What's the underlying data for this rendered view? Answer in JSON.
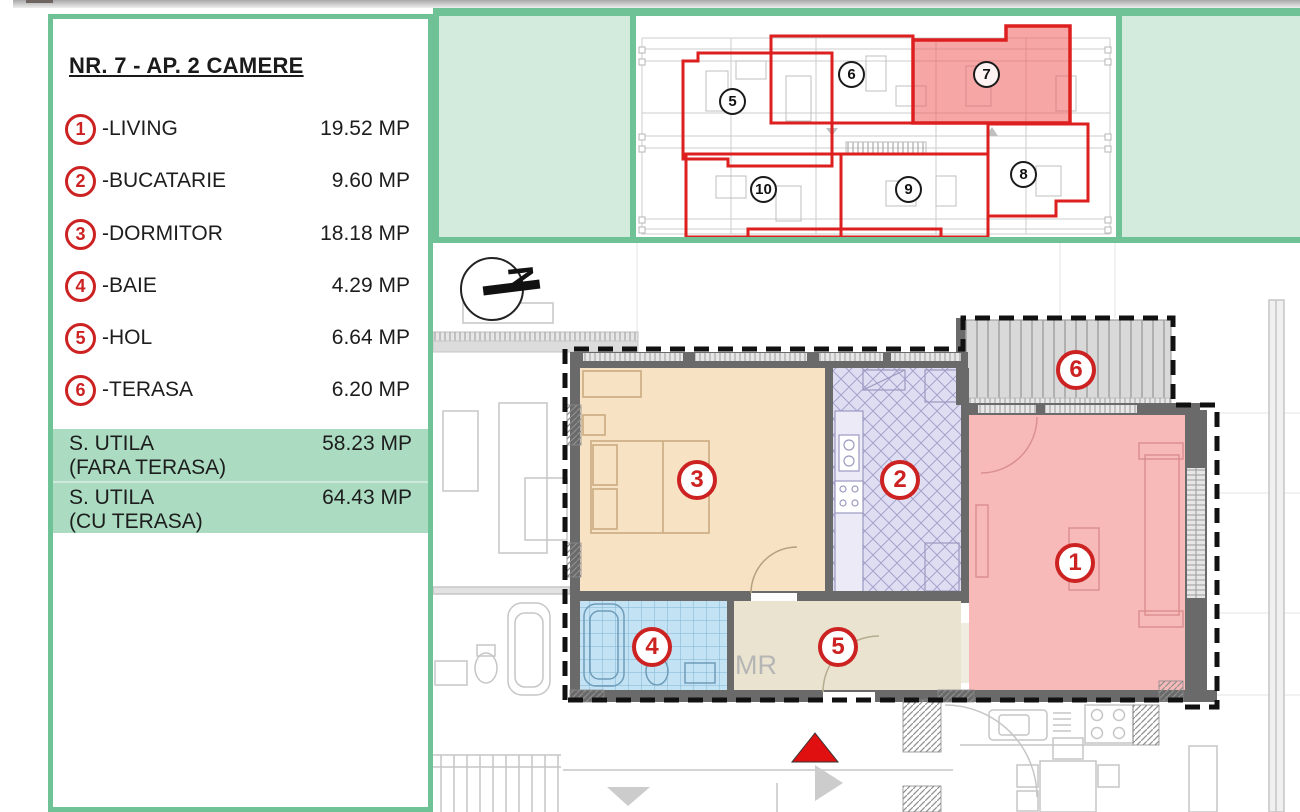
{
  "legend": {
    "title": "NR. 7 - AP. 2 CAMERE",
    "items": [
      {
        "num": "1",
        "label": "-LIVING",
        "area": "19.52 MP"
      },
      {
        "num": "2",
        "label": "-BUCATARIE",
        "area": "9.60 MP"
      },
      {
        "num": "3",
        "label": "-DORMITOR",
        "area": "18.18 MP"
      },
      {
        "num": "4",
        "label": "-BAIE",
        "area": "4.29 MP"
      },
      {
        "num": "5",
        "label": "-HOL",
        "area": "6.64 MP"
      },
      {
        "num": "6",
        "label": "-TERASA",
        "area": "6.20 MP"
      }
    ],
    "summary": [
      {
        "label": "S. UTILA",
        "sub": "(FARA TERASA)",
        "area": "58.23 MP"
      },
      {
        "label": "S. UTILA",
        "sub": "(CU TERASA)",
        "area": "64.43 MP"
      }
    ]
  },
  "overview": {
    "highlighted_unit": "7",
    "units": [
      {
        "num": "5"
      },
      {
        "num": "6"
      },
      {
        "num": "7"
      },
      {
        "num": "8"
      },
      {
        "num": "9"
      },
      {
        "num": "10"
      }
    ]
  },
  "plan": {
    "compass_letter": "N",
    "meter_label": "MR"
  },
  "colors": {
    "accent_green": "#6fc295",
    "light_green": "#d3ebdc",
    "summary_row_green": "#abdcc2",
    "accent_red": "#cc2222",
    "unit_outline_red": "#dd1f1f",
    "unit_highlight": "#f2a0a0",
    "room_living": "#f8b9b9",
    "room_kitchen": "#dfddf1",
    "room_bedroom": "#f7e2c4",
    "room_bath": "#c3e3f5",
    "room_hall": "#eae3d0",
    "room_terrace": "#d9d9d9"
  }
}
